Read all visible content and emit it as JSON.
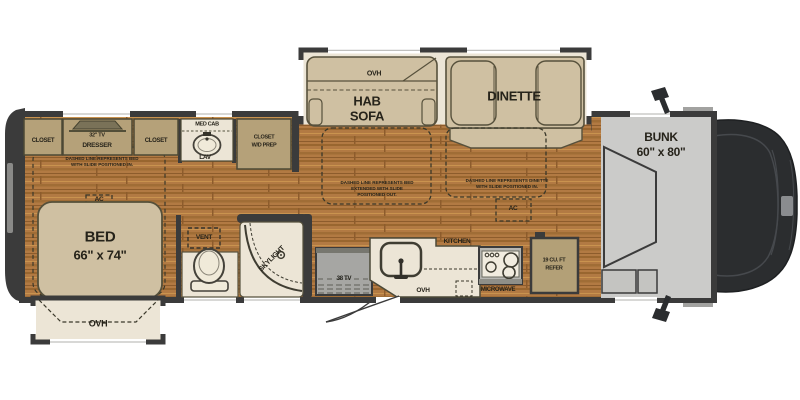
{
  "floorplan": {
    "colors": {
      "wall": "#3b3b3b",
      "wood_floor": "#b27a43",
      "furniture_tan": "#cfc0a2",
      "cabinet_tan": "#b5a179",
      "cream_floor": "#ece5d6",
      "appliance_gray": "#a6a6a3",
      "bunk_gray": "#cbcbc9",
      "cab_dark": "#2b2d2f"
    },
    "bedroom": {
      "closet_rear": "CLOSET",
      "tv": "32\" TV",
      "dresser": "DRESSER",
      "closet_front": "CLOSET",
      "note_line1": "DASHED LINE REPRESENTS BED",
      "note_line2": "WITH SLIDE POSITIONED IN.",
      "ac": "AC",
      "bed": "BED",
      "bed_size": "66\" x 74\"",
      "slide_ovh": "OVH"
    },
    "bath": {
      "med_cab": "MED CAB",
      "lav": "LAV",
      "closet_wd_line1": "CLOSET",
      "closet_wd_line2": "W/D PREP",
      "vent": "VENT",
      "skylight": "SKYLIGHT"
    },
    "living": {
      "sofa_ovh": "OVH",
      "sofa_line1": "HAB",
      "sofa_line2": "SOFA",
      "sofa_note_line1": "DASHED LINE REPRESENTS BED",
      "sofa_note_line2": "EXTENDED WITH SLIDE",
      "sofa_note_line3": "POSITIONED OUT.",
      "dinette": "DINETTE",
      "dinette_note_line1": "DASHED LINE REPRESENTS DINETTE",
      "dinette_note_line2": "WITH SLIDE POSITIONED IN.",
      "ac": "AC",
      "tv": "38 TV"
    },
    "kitchen": {
      "label": "KITCHEN",
      "ovh": "OVH",
      "microwave": "MICROWAVE",
      "refer_line1": "19 CU. FT",
      "refer_line2": "REFER"
    },
    "cab": {
      "bunk": "BUNK",
      "bunk_size": "60\" x 80\""
    }
  }
}
